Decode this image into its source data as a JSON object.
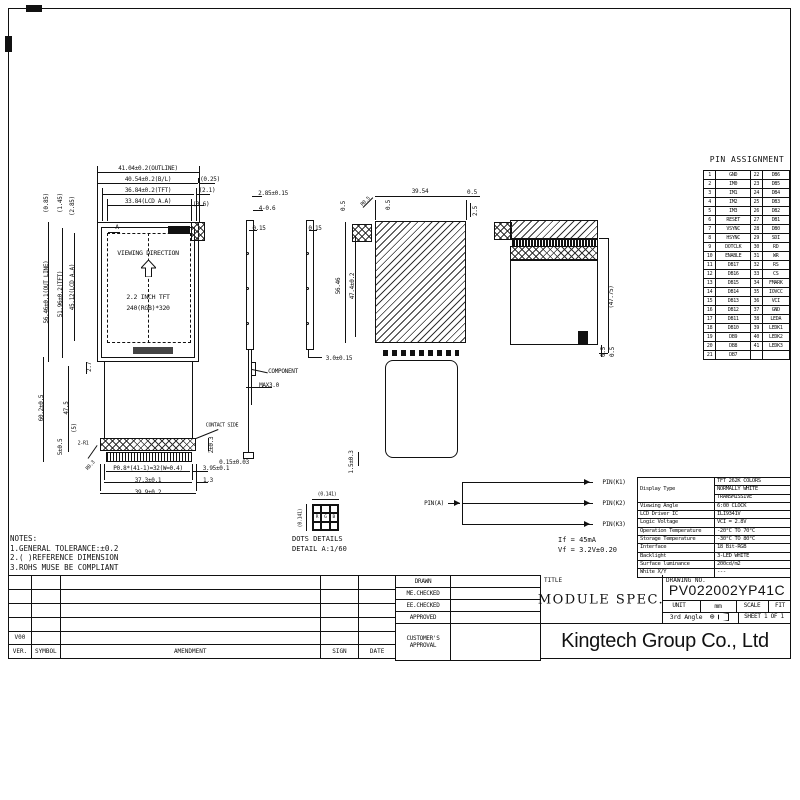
{
  "pin_assignment": {
    "title": "PIN ASSIGNMENT",
    "rows": [
      [
        "1",
        "GND",
        "22",
        "DB6"
      ],
      [
        "2",
        "IM0",
        "23",
        "DB5"
      ],
      [
        "3",
        "IM1",
        "24",
        "DB4"
      ],
      [
        "4",
        "IM2",
        "25",
        "DB3"
      ],
      [
        "5",
        "IM3",
        "26",
        "DB2"
      ],
      [
        "6",
        "RESET",
        "27",
        "DB1"
      ],
      [
        "7",
        "VSYNC",
        "28",
        "DB0"
      ],
      [
        "8",
        "HSYNC",
        "29",
        "SDI"
      ],
      [
        "9",
        "DOTCLK",
        "30",
        "RD"
      ],
      [
        "10",
        "ENABLE",
        "31",
        "WR"
      ],
      [
        "11",
        "DB17",
        "32",
        "RS"
      ],
      [
        "12",
        "DB16",
        "33",
        "CS"
      ],
      [
        "13",
        "DB15",
        "34",
        "FMARK"
      ],
      [
        "14",
        "DB14",
        "35",
        "IOVCC"
      ],
      [
        "15",
        "DB13",
        "36",
        "VCI"
      ],
      [
        "16",
        "DB12",
        "37",
        "GND"
      ],
      [
        "17",
        "DB11",
        "38",
        "LEDA"
      ],
      [
        "18",
        "DB10",
        "39",
        "LEDK1"
      ],
      [
        "19",
        "DB9",
        "40",
        "LEDK2"
      ],
      [
        "20",
        "DB8",
        "41",
        "LEDK3"
      ],
      [
        "21",
        "DB7",
        "",
        ""
      ]
    ]
  },
  "spec_table": {
    "display_type_label": "Display Type",
    "display_type_values": [
      "TFT 262K COLORS",
      "NORMALLY WHITE",
      "TRANSMISSIVE"
    ],
    "rows": [
      [
        "Viewing Angle",
        "6:00 CLOCK"
      ],
      [
        "LCD Driver IC",
        "ILI9341V"
      ],
      [
        "Logic Voltage",
        "VCI = 2.8V"
      ],
      [
        "Operation Temperature",
        "-20°C TO 70°C"
      ],
      [
        "Storage Temperature",
        "-30°C TO 80°C"
      ],
      [
        "Interface",
        "18 Bit-RGB"
      ],
      [
        "Backlight",
        "3-LED WHITE"
      ],
      [
        "Surface luminance",
        "200cd/m2"
      ],
      [
        "White X/Y",
        "---"
      ]
    ]
  },
  "title_block": {
    "title_label": "TITLE",
    "title": "MODULE SPEC.",
    "drawing_no_label": "DRAWING NO.",
    "drawing_no": "PV022002YP41C",
    "unit_label": "UNIT",
    "unit_value": "mm",
    "scale_label": "SCALE",
    "scale_value": "FIT",
    "angle_label": "3rd Angle",
    "sheet_label": "SHEET 1 OF 1",
    "company": "Kingtech Group Co., Ltd",
    "approval_rows": [
      "DRAWN",
      "ME.CHECKED",
      "EE.CHECKED",
      "APPROVED",
      "CUSTOMER'S APPROVAL"
    ],
    "revision": {
      "headers": [
        "VER.",
        "SYMBOL",
        "AMENDMENT",
        "SIGN",
        "DATE"
      ],
      "rows": [
        [
          "",
          "",
          "",
          "",
          ""
        ],
        [
          "",
          "",
          "",
          "",
          ""
        ],
        [
          "",
          "",
          "",
          "",
          ""
        ],
        [
          "",
          "",
          "",
          "",
          ""
        ],
        [
          "V00",
          "",
          "",
          "",
          ""
        ]
      ]
    }
  },
  "notes": {
    "heading": "NOTES:",
    "items": [
      "1.GENERAL TOLERANCE:±0.2",
      "2.( )REFERENCE DIMENSION",
      "3.ROHS MUSE BE COMPLIANT"
    ]
  },
  "front_view": {
    "viewing_direction": "VIEWING DIRECTION",
    "size_label": "2.2 INCH TFT",
    "resolution": "240(RGB)*320"
  },
  "dots_detail": {
    "line1": "DOTS DETAILS",
    "line2": "DETAIL A:1/60",
    "dim_h": "(0.141)",
    "dim_v": "(0.141)",
    "subpixels": [
      "R",
      "G",
      "B"
    ]
  },
  "backlight": {
    "pin_a": "PIN(A)",
    "pins": [
      "PIN(K1)",
      "PIN(K2)",
      "PIN(K3)"
    ],
    "current": "If  =  45mA",
    "voltage": "Vf  =  3.2V±0.20"
  },
  "annotations": [
    "41.04±0.2(OUTLINE)",
    "40.54±0.2(B/L)",
    "36.84±0.2(TFT)",
    "33.84(LCD A.A)",
    "(0.25)",
    "(2.1)",
    "(3.6)",
    "56.46±0.1(OUT LINE)",
    "51.96±0.2(TFT)",
    "45.12(LCD A.A)",
    "(0.85)",
    "(1.45)",
    "(2.85)",
    "60.2±0.5",
    "47.5",
    "2.7",
    "(5)",
    "5±0.5",
    "2-R1",
    "R0.3",
    "P0.8*(41-1)=32(W=0.4)",
    "37.3±0.1",
    "39.9±0.2",
    "3.95±0.1",
    "1.3",
    "2±0.3",
    "CONTACT SIDE",
    "2.85±0.15",
    "4-0.6",
    "0.15",
    "COMPONENT",
    "MAX3.0",
    "0.15±0.03",
    "0.15",
    "3.0±0.15",
    "39.54",
    "0.5",
    "R0.5",
    "0.5",
    "0.5",
    "2.5",
    "47.4±0.2",
    "56.46",
    "1.5±0.3",
    "(47.75)",
    "0.5",
    "0.5",
    "A"
  ]
}
